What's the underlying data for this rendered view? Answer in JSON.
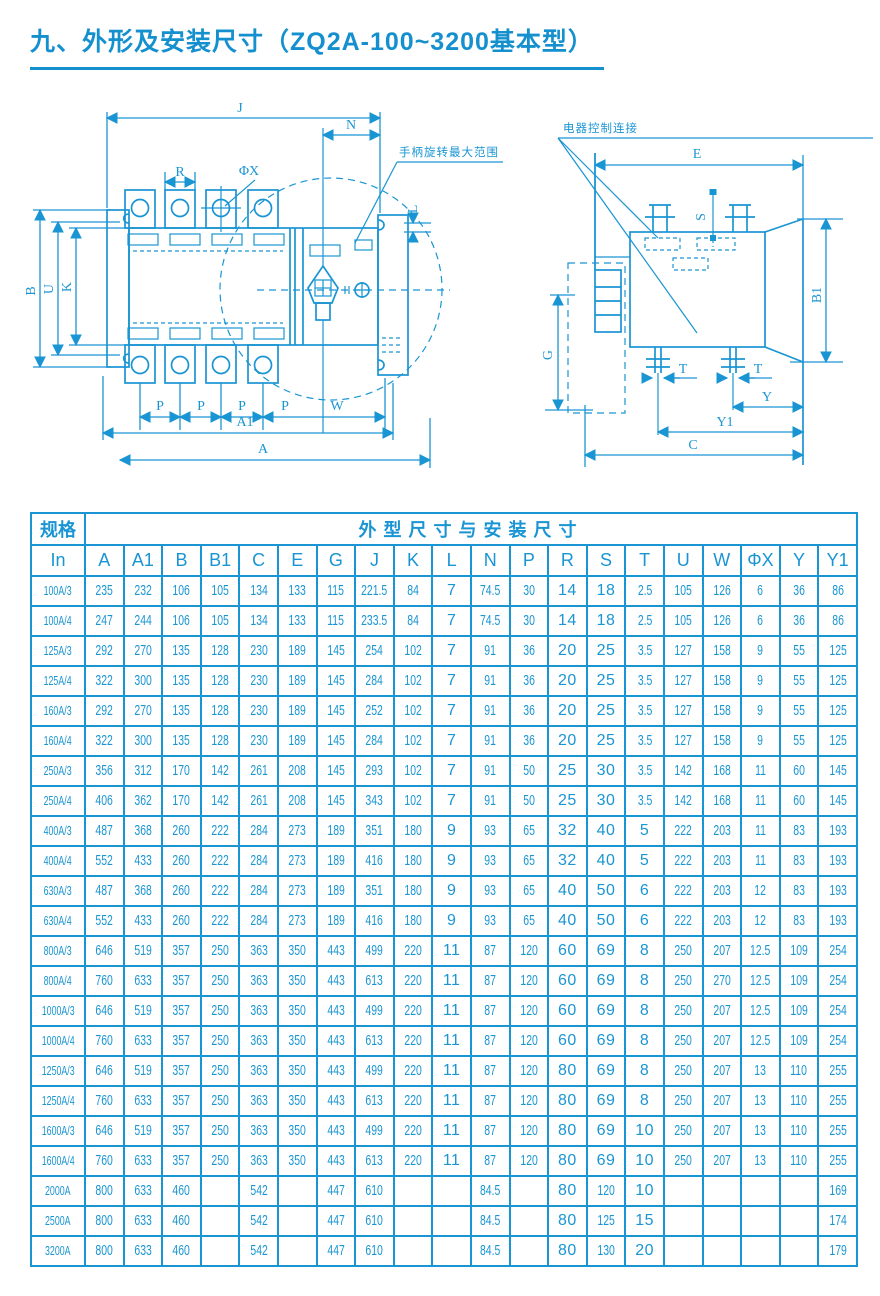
{
  "page": {
    "title": "九、外形及安装尺寸（ZQ2A-100~3200基本型）"
  },
  "drawings": {
    "front_view": {
      "handle_note": "手柄旋转最大范围",
      "dims": {
        "J": "J",
        "N": "N",
        "R": "R",
        "phiX": "ΦX",
        "B": "B",
        "U": "U",
        "K": "K",
        "L": "L",
        "P": "P",
        "W": "W",
        "A1": "A1",
        "A": "A"
      }
    },
    "side_view": {
      "control_note": "电器控制连接",
      "dims": {
        "E": "E",
        "S": "S",
        "B1": "B1",
        "G": "G",
        "T": "T",
        "Y": "Y",
        "Y1": "Y1",
        "C": "C"
      }
    }
  },
  "table": {
    "spec_header": "规格",
    "size_header": "外型尺寸与安装尺寸",
    "columns": [
      "In",
      "A",
      "A1",
      "B",
      "B1",
      "C",
      "E",
      "G",
      "J",
      "K",
      "L",
      "N",
      "P",
      "R",
      "S",
      "T",
      "U",
      "W",
      "ΦX",
      "Y",
      "Y1"
    ],
    "rows": [
      {
        "spec": "100A/3",
        "values": [
          "235",
          "232",
          "106",
          "105",
          "134",
          "133",
          "115",
          "221.5",
          "84",
          "7",
          "74.5",
          "30",
          "14",
          "18",
          "2.5",
          "105",
          "126",
          "6",
          "36",
          "86"
        ]
      },
      {
        "spec": "100A/4",
        "values": [
          "247",
          "244",
          "106",
          "105",
          "134",
          "133",
          "115",
          "233.5",
          "84",
          "7",
          "74.5",
          "30",
          "14",
          "18",
          "2.5",
          "105",
          "126",
          "6",
          "36",
          "86"
        ]
      },
      {
        "spec": "125A/3",
        "values": [
          "292",
          "270",
          "135",
          "128",
          "230",
          "189",
          "145",
          "254",
          "102",
          "7",
          "91",
          "36",
          "20",
          "25",
          "3.5",
          "127",
          "158",
          "9",
          "55",
          "125"
        ]
      },
      {
        "spec": "125A/4",
        "values": [
          "322",
          "300",
          "135",
          "128",
          "230",
          "189",
          "145",
          "284",
          "102",
          "7",
          "91",
          "36",
          "20",
          "25",
          "3.5",
          "127",
          "158",
          "9",
          "55",
          "125"
        ]
      },
      {
        "spec": "160A/3",
        "values": [
          "292",
          "270",
          "135",
          "128",
          "230",
          "189",
          "145",
          "252",
          "102",
          "7",
          "91",
          "36",
          "20",
          "25",
          "3.5",
          "127",
          "158",
          "9",
          "55",
          "125"
        ]
      },
      {
        "spec": "160A/4",
        "values": [
          "322",
          "300",
          "135",
          "128",
          "230",
          "189",
          "145",
          "284",
          "102",
          "7",
          "91",
          "36",
          "20",
          "25",
          "3.5",
          "127",
          "158",
          "9",
          "55",
          "125"
        ]
      },
      {
        "spec": "250A/3",
        "values": [
          "356",
          "312",
          "170",
          "142",
          "261",
          "208",
          "145",
          "293",
          "102",
          "7",
          "91",
          "50",
          "25",
          "30",
          "3.5",
          "142",
          "168",
          "11",
          "60",
          "145"
        ]
      },
      {
        "spec": "250A/4",
        "values": [
          "406",
          "362",
          "170",
          "142",
          "261",
          "208",
          "145",
          "343",
          "102",
          "7",
          "91",
          "50",
          "25",
          "30",
          "3.5",
          "142",
          "168",
          "11",
          "60",
          "145"
        ]
      },
      {
        "spec": "400A/3",
        "values": [
          "487",
          "368",
          "260",
          "222",
          "284",
          "273",
          "189",
          "351",
          "180",
          "9",
          "93",
          "65",
          "32",
          "40",
          "5",
          "222",
          "203",
          "11",
          "83",
          "193"
        ]
      },
      {
        "spec": "400A/4",
        "values": [
          "552",
          "433",
          "260",
          "222",
          "284",
          "273",
          "189",
          "416",
          "180",
          "9",
          "93",
          "65",
          "32",
          "40",
          "5",
          "222",
          "203",
          "11",
          "83",
          "193"
        ]
      },
      {
        "spec": "630A/3",
        "values": [
          "487",
          "368",
          "260",
          "222",
          "284",
          "273",
          "189",
          "351",
          "180",
          "9",
          "93",
          "65",
          "40",
          "50",
          "6",
          "222",
          "203",
          "12",
          "83",
          "193"
        ]
      },
      {
        "spec": "630A/4",
        "values": [
          "552",
          "433",
          "260",
          "222",
          "284",
          "273",
          "189",
          "416",
          "180",
          "9",
          "93",
          "65",
          "40",
          "50",
          "6",
          "222",
          "203",
          "12",
          "83",
          "193"
        ]
      },
      {
        "spec": "800A/3",
        "values": [
          "646",
          "519",
          "357",
          "250",
          "363",
          "350",
          "443",
          "499",
          "220",
          "11",
          "87",
          "120",
          "60",
          "69",
          "8",
          "250",
          "207",
          "12.5",
          "109",
          "254"
        ]
      },
      {
        "spec": "800A/4",
        "values": [
          "760",
          "633",
          "357",
          "250",
          "363",
          "350",
          "443",
          "613",
          "220",
          "11",
          "87",
          "120",
          "60",
          "69",
          "8",
          "250",
          "270",
          "12.5",
          "109",
          "254"
        ]
      },
      {
        "spec": "1000A/3",
        "values": [
          "646",
          "519",
          "357",
          "250",
          "363",
          "350",
          "443",
          "499",
          "220",
          "11",
          "87",
          "120",
          "60",
          "69",
          "8",
          "250",
          "207",
          "12.5",
          "109",
          "254"
        ]
      },
      {
        "spec": "1000A/4",
        "values": [
          "760",
          "633",
          "357",
          "250",
          "363",
          "350",
          "443",
          "613",
          "220",
          "11",
          "87",
          "120",
          "60",
          "69",
          "8",
          "250",
          "207",
          "12.5",
          "109",
          "254"
        ]
      },
      {
        "spec": "1250A/3",
        "values": [
          "646",
          "519",
          "357",
          "250",
          "363",
          "350",
          "443",
          "499",
          "220",
          "11",
          "87",
          "120",
          "80",
          "69",
          "8",
          "250",
          "207",
          "13",
          "110",
          "255"
        ]
      },
      {
        "spec": "1250A/4",
        "values": [
          "760",
          "633",
          "357",
          "250",
          "363",
          "350",
          "443",
          "613",
          "220",
          "11",
          "87",
          "120",
          "80",
          "69",
          "8",
          "250",
          "207",
          "13",
          "110",
          "255"
        ]
      },
      {
        "spec": "1600A/3",
        "values": [
          "646",
          "519",
          "357",
          "250",
          "363",
          "350",
          "443",
          "499",
          "220",
          "11",
          "87",
          "120",
          "80",
          "69",
          "10",
          "250",
          "207",
          "13",
          "110",
          "255"
        ]
      },
      {
        "spec": "1600A/4",
        "values": [
          "760",
          "633",
          "357",
          "250",
          "363",
          "350",
          "443",
          "613",
          "220",
          "11",
          "87",
          "120",
          "80",
          "69",
          "10",
          "250",
          "207",
          "13",
          "110",
          "255"
        ]
      },
      {
        "spec": "2000A",
        "values": [
          "800",
          "633",
          "460",
          "",
          "542",
          "",
          "447",
          "610",
          "",
          "",
          "84.5",
          "",
          "80",
          "120",
          "10",
          "",
          "",
          "",
          "",
          "169"
        ]
      },
      {
        "spec": "2500A",
        "values": [
          "800",
          "633",
          "460",
          "",
          "542",
          "",
          "447",
          "610",
          "",
          "",
          "84.5",
          "",
          "80",
          "125",
          "15",
          "",
          "",
          "",
          "",
          "174"
        ]
      },
      {
        "spec": "3200A",
        "values": [
          "800",
          "633",
          "460",
          "",
          "542",
          "",
          "447",
          "610",
          "",
          "",
          "84.5",
          "",
          "80",
          "130",
          "20",
          "",
          "",
          "",
          "",
          "179"
        ]
      }
    ]
  }
}
